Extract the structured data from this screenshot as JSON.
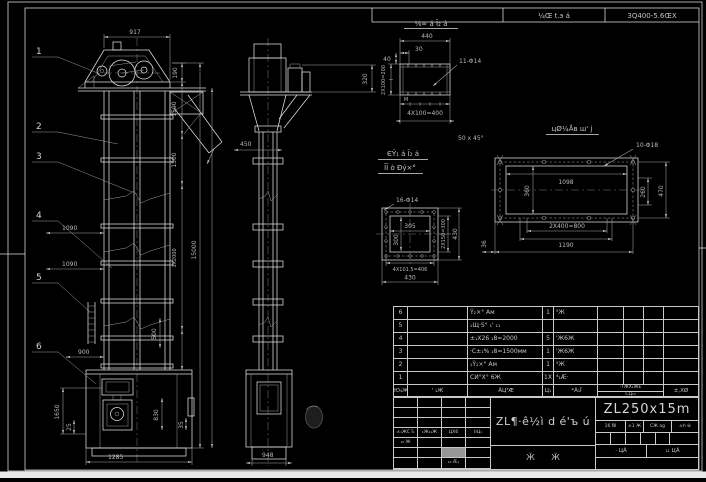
{
  "header_strip": {
    "doc_label": "¼Œ t.э á",
    "model_code": "3Q400-5.6ŒX"
  },
  "balloons": [
    "1",
    "2",
    "3",
    "4",
    "5",
    "6"
  ],
  "front_view": {
    "dim_width_top": "917",
    "dim_190": "190",
    "dim_1590": "1590",
    "dim_1500": "1500",
    "dim_3x2000": "3X2000",
    "dim_total_height": "15000",
    "dim_1090_upper": "1090",
    "dim_1090_lower": "1090",
    "dim_900": "900",
    "dim_1285": "1285",
    "dim_1650": "1650",
    "dim_25": "25",
    "dim_830": "830",
    "dim_35": "35",
    "dim_500": "500"
  },
  "side_view": {
    "dim_450": "450",
    "dim_320": "320",
    "dim_948": "948"
  },
  "detail_top_flange": {
    "title": "⅛∞ á Ī₂ á",
    "dim_440": "440",
    "dim_30": "30",
    "dim_40": "40",
    "dim_left": "2X100=200",
    "holes": "11-Φ14",
    "dim_bottom": "4X100=400",
    "weld_mark": "M",
    "chamfer_note": "50 x 45°"
  },
  "detail_square_flange": {
    "title_line1": "ЄΫ₁ á Ī₂ á",
    "title_line2": "ĪĪ ò Đý×°",
    "holes": "16-Φ14",
    "dim_width": "305",
    "dim_height": "300",
    "dim_right_pitch": "2X150=300",
    "dim_right_overall": "430",
    "dim_bottom_pitch": "4X101.5=406",
    "dim_bottom_overall": "430"
  },
  "detail_plate": {
    "title": "цØ¼Åв ш' ј",
    "holes": "10-Φ18",
    "dim_1098": "1098",
    "dim_360": "360",
    "dim_260": "260",
    "dim_470": "470",
    "dim_2x400": "2X400=800",
    "dim_1190": "1190",
    "dim_36": "36"
  },
  "bom": {
    "rows": [
      [
        "6",
        "",
        "Ÿ₂×° Ам",
        "1",
        "⁵Ж",
        "",
        "",
        "",
        ""
      ],
      [
        "5",
        "",
        "₁Щ·Ѕ° ₁' ₁₁",
        "",
        "",
        "",
        "",
        "",
        ""
      ],
      [
        "4",
        "",
        "±₁Х26 ₁8=2000",
        "5",
        "'Ж6Ж",
        "",
        "",
        "",
        ""
      ],
      [
        "3",
        "",
        "·С±₁% ₁8=1500мм",
        "1",
        "'Ж6Ж",
        "",
        "",
        "",
        ""
      ],
      [
        "2",
        "",
        "₁Ÿ₂×° Ам",
        "1",
        "⁵Ж",
        "",
        "",
        "",
        ""
      ],
      [
        "1",
        "",
        "СИ°Х° 6Ж",
        "1Х",
        "⁴₁Æ·",
        "",
        "",
        "",
        ""
      ]
    ],
    "header": {
      "col_no": "Ю₄Ж",
      "col_dwg": "' ₁Ж",
      "col_name": "ÃЦ³Æ",
      "col_qty": "Ц₁",
      "col_material": "*Ã₁Ī",
      "col_weight_top": "·ΤЖХ₁ЖЕ",
      "col_weight_bottom": "СЦ₁₄",
      "col_remark": "±,ХØ"
    }
  },
  "title_block": {
    "left": {
      "h1": "±₁ЖϹ Ĭ₁",
      "h2": "₁Ж₁₁Ж",
      "h3": "ЦХ6",
      "h4": "ϷЦ₁",
      "r5c1": "₁₆ Ж",
      "r7c3": "₁₀ Æ₁"
    },
    "product_name": "ZL¶·ê½ì d é'ъ ú",
    "sheet_note": "Ӂ Ӝ",
    "model": "ZL250x15m",
    "spec_cells": [
      "16 Ñl",
      "±1 Ж",
      "СЖ ag",
      "±h ŵ"
    ],
    "approve_cells": [
      "· ЦÃ",
      "₁₁ ЦÃ"
    ]
  }
}
